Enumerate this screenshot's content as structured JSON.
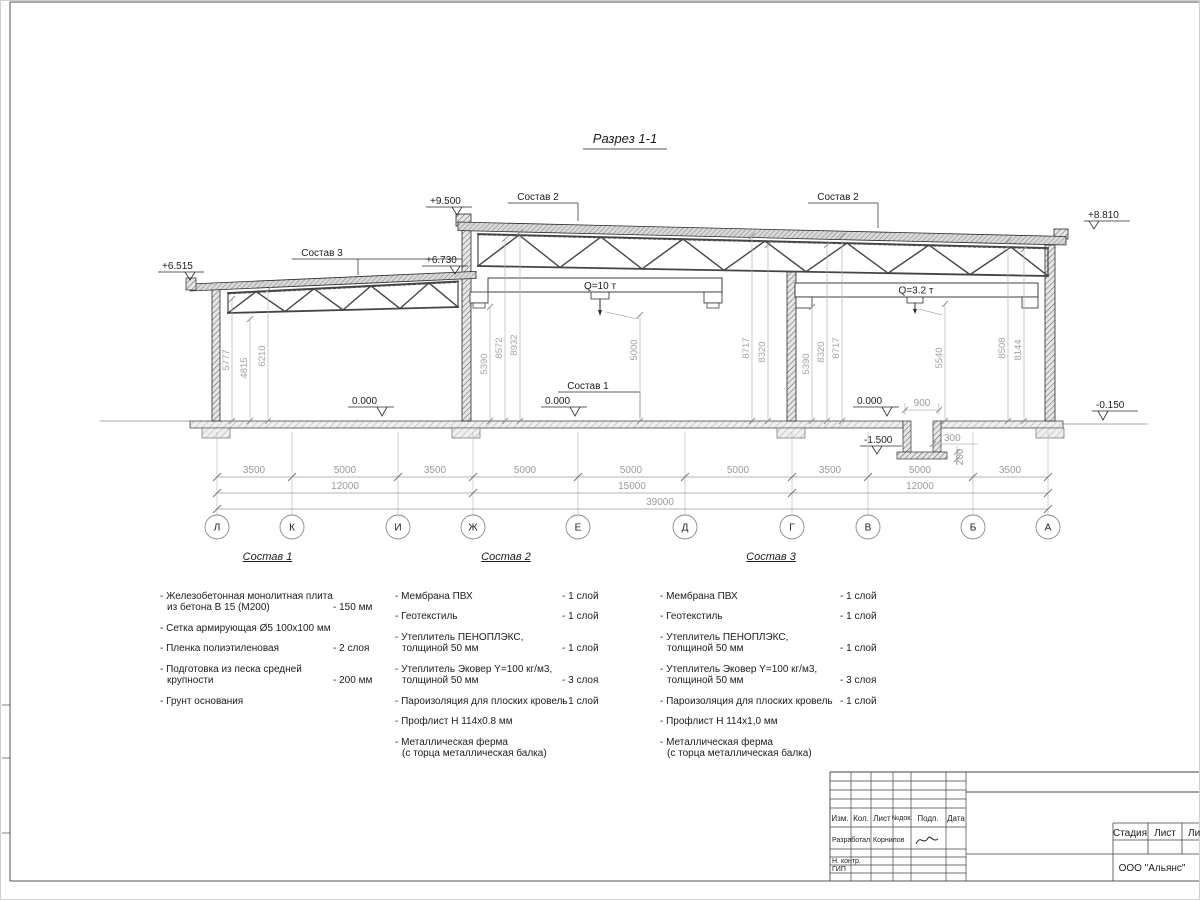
{
  "sheet": {
    "title": "Разрез 1-1"
  },
  "drawing": {
    "elevations": {
      "high_left": "+9.500",
      "low_left": "+6.515",
      "low_right": "+6.730",
      "high_right": "+8.810",
      "floor_1": "0.000",
      "floor_2": "0.000",
      "floor_3": "0.000",
      "ground_right": "-0.150",
      "pit": "-1.500"
    },
    "labels": {
      "sostav1": "Состав 1",
      "sostav2_left": "Состав 2",
      "sostav2_right": "Состав 2",
      "sostav3": "Состав 3"
    },
    "cranes": {
      "left": "Q=10 т",
      "right": "Q=3.2 т"
    },
    "vdims": [
      "5777",
      "4815",
      "6210",
      "5390",
      "8572",
      "8932",
      "5000",
      "8717",
      "8320",
      "5390",
      "8320",
      "8717",
      "5540",
      "8508",
      "8144"
    ],
    "pit_dims": {
      "width": "900",
      "wall": "300",
      "slab": "200"
    }
  },
  "grid": {
    "letters": [
      "Л",
      "К",
      "И",
      "Ж",
      "Е",
      "Д",
      "Г",
      "В",
      "Б",
      "А"
    ],
    "spans": [
      "3500",
      "5000",
      "3500",
      "5000",
      "5000",
      "5000",
      "3500",
      "5000",
      "3500"
    ],
    "groups": [
      "12000",
      "15000",
      "12000"
    ],
    "total": "39000"
  },
  "compositions": [
    {
      "title": "Состав 1",
      "items": [
        {
          "lines": [
            "- Железобетонная  монолитная плита",
            "из бетона В 15 (М200)"
          ],
          "value": "- 150 мм"
        },
        {
          "lines": [
            "- Сетка армирующая Ø5 100х100 мм"
          ],
          "value": ""
        },
        {
          "lines": [
            "- Пленка полиэтиленовая"
          ],
          "value": "-  2 слоя"
        },
        {
          "lines": [
            "- Подготовка из песка средней",
            "крупности"
          ],
          "value": "- 200 мм"
        },
        {
          "lines": [
            "- Грунт основания"
          ],
          "value": ""
        }
      ]
    },
    {
      "title": "Состав 2",
      "items": [
        {
          "lines": [
            "- Мембрана ПВХ"
          ],
          "value": "- 1 слой"
        },
        {
          "lines": [
            "- Геотекстиль"
          ],
          "value": "- 1 слой"
        },
        {
          "lines": [
            "- Утеплитель ПЕНОПЛЭКС,",
            "толщиной 50 мм"
          ],
          "value": "- 1 слой"
        },
        {
          "lines": [
            "- Утеплитель Эковер Y=100 кг/м3,",
            "толщиной 50 мм"
          ],
          "value": "- 3 слоя"
        },
        {
          "lines": [
            "- Пароизоляция для плоских кровель"
          ],
          "value": "- 1 слой"
        },
        {
          "lines": [
            "- Профлист Н 114х0.8 мм"
          ],
          "value": ""
        },
        {
          "lines": [
            "- Металлическая ферма",
            "(с торца металлическая балка)"
          ],
          "value": ""
        }
      ]
    },
    {
      "title": "Состав 3",
      "items": [
        {
          "lines": [
            "- Мембрана ПВХ"
          ],
          "value": "- 1 слой"
        },
        {
          "lines": [
            "- Геотекстиль"
          ],
          "value": "- 1 слой"
        },
        {
          "lines": [
            "- Утеплитель ПЕНОПЛЭКС,",
            "толщиной 50 мм"
          ],
          "value": "- 1 слой"
        },
        {
          "lines": [
            "- Утеплитель Эковер Y=100 кг/м3,",
            "толщиной 50 мм"
          ],
          "value": "- 3 слоя"
        },
        {
          "lines": [
            "- Пароизоляция для плоских кровель"
          ],
          "value": "- 1 слой"
        },
        {
          "lines": [
            "- Профлист Н 114х1,0 мм"
          ],
          "value": ""
        },
        {
          "lines": [
            "- Металлическая ферма",
            "(с торца металлическая балка)"
          ],
          "value": ""
        }
      ]
    }
  ],
  "titleblock": {
    "cols": [
      "Изм.",
      "Кол.",
      "Лист",
      "№док.",
      "Подп.",
      "Дата"
    ],
    "developer_label": "Разработал",
    "developer_name": "Корнилов",
    "ncontr_label": "Н. контр.",
    "gip_label": "ГИП",
    "stage_label": "Стадия",
    "sheet_label": "Лист",
    "sheets_label": "Лис",
    "company": "ООО \"Альянс\""
  }
}
